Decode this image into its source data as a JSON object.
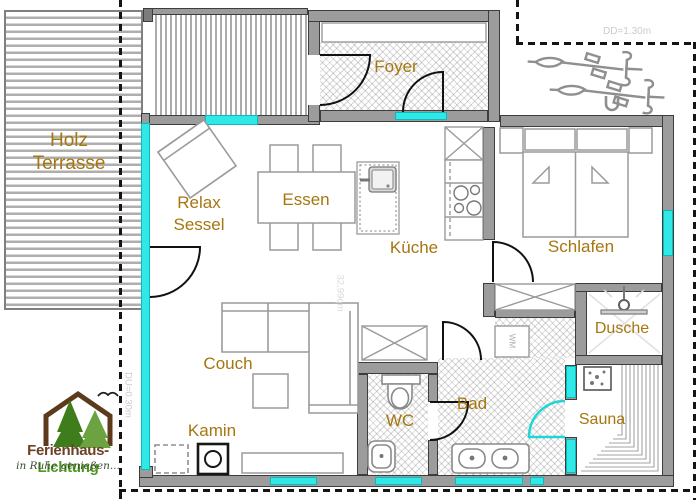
{
  "rooms": {
    "terrace_line1": "Holz",
    "terrace_line2": "Terrasse",
    "foyer": "Foyer",
    "relax_line1": "Relax",
    "relax_line2": "Sessel",
    "essen": "Essen",
    "kueche": "Küche",
    "schlafen": "Schlafen",
    "couch": "Couch",
    "kamin": "Kamin",
    "wc": "WC",
    "bad": "Bad",
    "dusche": "Dusche",
    "sauna": "Sauna"
  },
  "annotations": {
    "dd": "DD=1.30m",
    "du": "DU=0.30m",
    "area": "32,99qm",
    "wm": "WM"
  },
  "logo": {
    "part1": "Ferienhaus-",
    "part2": "Lichtung",
    "tagline": "in Ruhe genießen..."
  },
  "colors": {
    "glass": "#2fe9e9",
    "wall": "#9c9c9c",
    "label": "#a6760f"
  }
}
